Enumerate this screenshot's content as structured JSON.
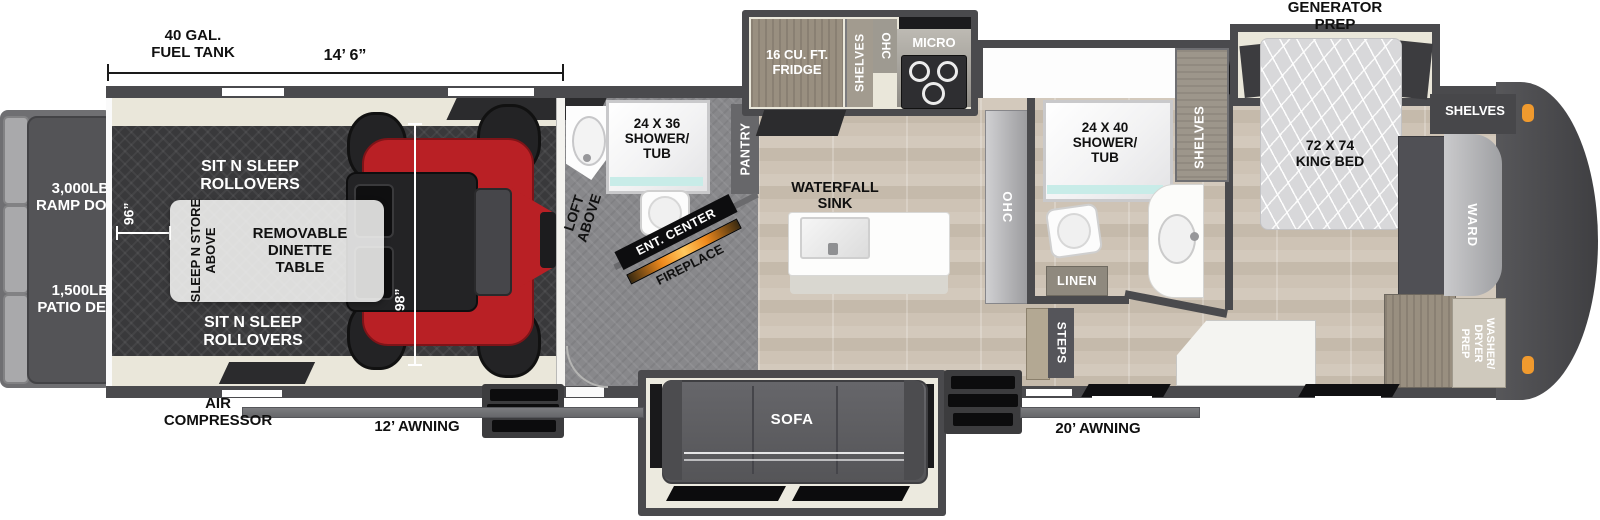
{
  "dims": {
    "fuel1": "40 GAL.",
    "fuel2": "FUEL TANK",
    "length": "14’ 6”",
    "w96": "96”",
    "h98": "98”"
  },
  "rear": {
    "ramp1": "3,000LB.",
    "ramp2": "RAMP DOOR",
    "patio1": "1,500LB.",
    "patio2": "PATIO DECK"
  },
  "garage": {
    "rollover1": "SIT N SLEEP",
    "rollover2": "ROLLOVERS",
    "sleepstore1": "SLEEP N STORE",
    "sleepstore2": "ABOVE",
    "dinette1": "REMOVABLE",
    "dinette2": "DINETTE",
    "dinette3": "TABLE"
  },
  "midbath": {
    "shower1": "24 X 36",
    "shower2": "SHOWER/",
    "shower3": "TUB",
    "loft1": "LOFT",
    "loft2": "ABOVE",
    "pantry": "PANTRY",
    "entcenter": "ENT. CENTER",
    "fireplace": "FIREPLACE"
  },
  "kitchen": {
    "fridge1": "16 CU. FT.",
    "fridge2": "FRIDGE",
    "shelves": "SHELVES",
    "ohc": "OHC",
    "micro": "MICRO",
    "sink1": "WATERFALL",
    "sink2": "SINK",
    "ohc_counter": "OHC"
  },
  "bath": {
    "shower1": "24 X 40",
    "shower2": "SHOWER/",
    "shower3": "TUB",
    "shelves": "SHELVES",
    "linen": "LINEN",
    "steps": "STEPS"
  },
  "bedroom": {
    "gen1": "GENERATOR",
    "gen2": "PREP",
    "bed1": "72 X 74",
    "bed2": "KING BED",
    "shelves_right": "SHELVES",
    "ward": "WARD",
    "wd1": "WASHER/",
    "wd2": "DRYER",
    "wd3": "PREP"
  },
  "exterior": {
    "air1": "AIR",
    "air2": "COMPRESSOR",
    "awning12": "12’ AWNING",
    "awning20": "20’ AWNING",
    "sofa": "SOFA"
  },
  "colors": {
    "utv_red": "#b92025",
    "marker_orange": "#f09a2e",
    "glass_teal": "#c8ece8",
    "wall_gray": "#4a4a4d"
  }
}
